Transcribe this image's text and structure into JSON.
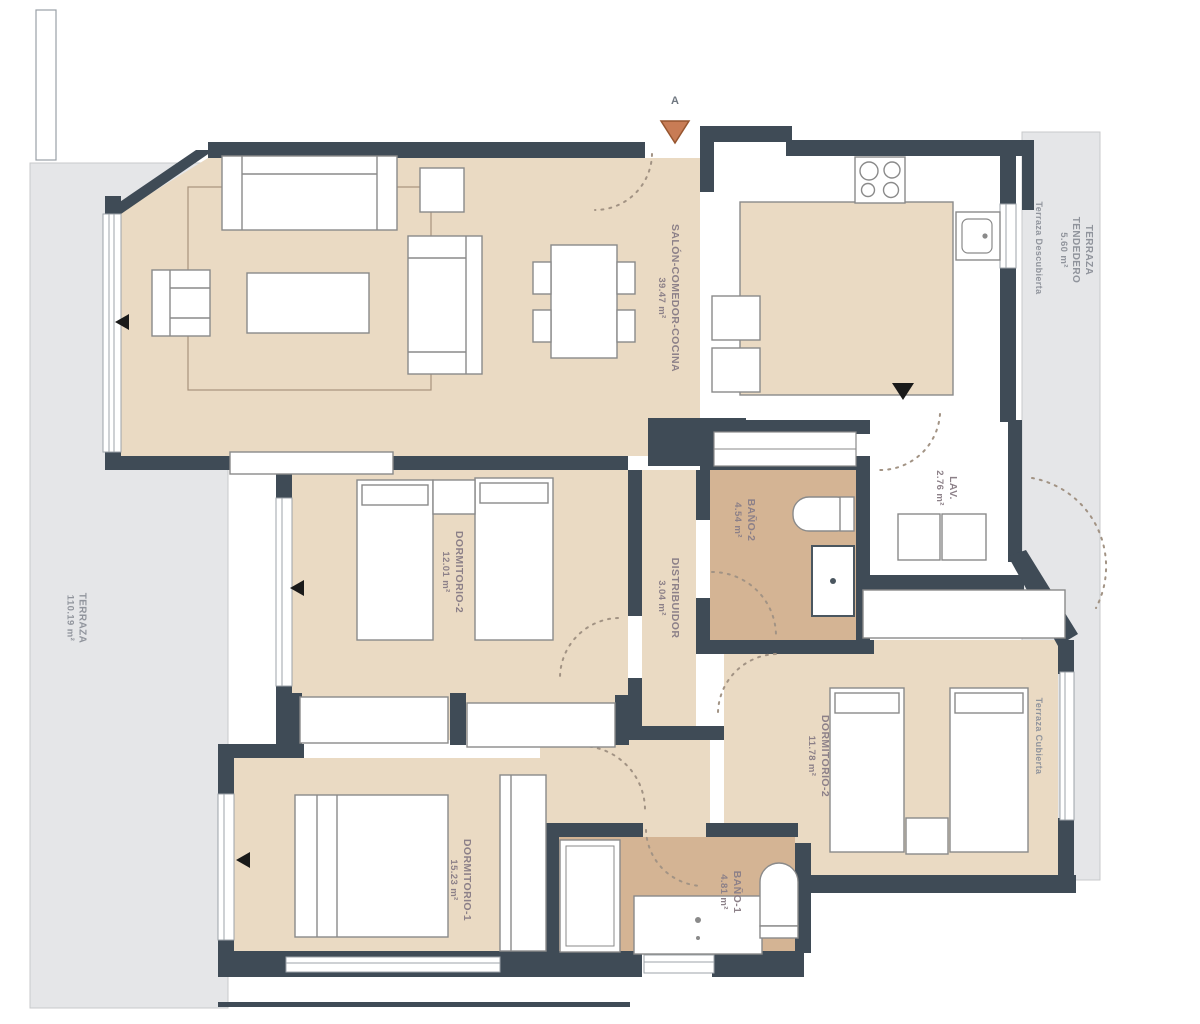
{
  "plan": {
    "marker_a": "A",
    "rooms": [
      {
        "id": "salon",
        "name": "SALÓN-COMEDOR-COCINA",
        "area": "39.47 m²"
      },
      {
        "id": "dormitorio2",
        "name": "DORMITORIO-2",
        "area": "12.01 m²"
      },
      {
        "id": "distribuidor",
        "name": "DISTRIBUIDOR",
        "area": "3.04 m²"
      },
      {
        "id": "bano2",
        "name": "BAÑO-2",
        "area": "4.54 m²"
      },
      {
        "id": "lavadero",
        "name": "LAV.",
        "area": "2.76 m²"
      },
      {
        "id": "dormitorio2b",
        "name": "DORMITORIO-2",
        "area": "11.78 m²"
      },
      {
        "id": "dormitorio1",
        "name": "DORMITORIO-1",
        "area": "15.23 m²"
      },
      {
        "id": "bano1",
        "name": "BAÑO-1",
        "area": "4.81 m²"
      },
      {
        "id": "terraza",
        "name": "TERRAZA",
        "area": "110.19 m²"
      },
      {
        "id": "tendedero",
        "name": "TERRAZA TENDEDERO",
        "area": "5.60 m²"
      }
    ],
    "annotations": [
      {
        "label": "Terraza Descubierta"
      },
      {
        "label": "Terraza Cubierta"
      }
    ],
    "colors": {
      "wall": "#3F4B56",
      "floor_interior": "#EADAC3",
      "floor_bath": "#D4B494",
      "terrace": "#E5E6E8",
      "furniture_stroke": "#8A8A8A",
      "entrance_marker": "#C87C55",
      "label_room": "#8C8088",
      "label_terrace": "#90949C"
    }
  }
}
